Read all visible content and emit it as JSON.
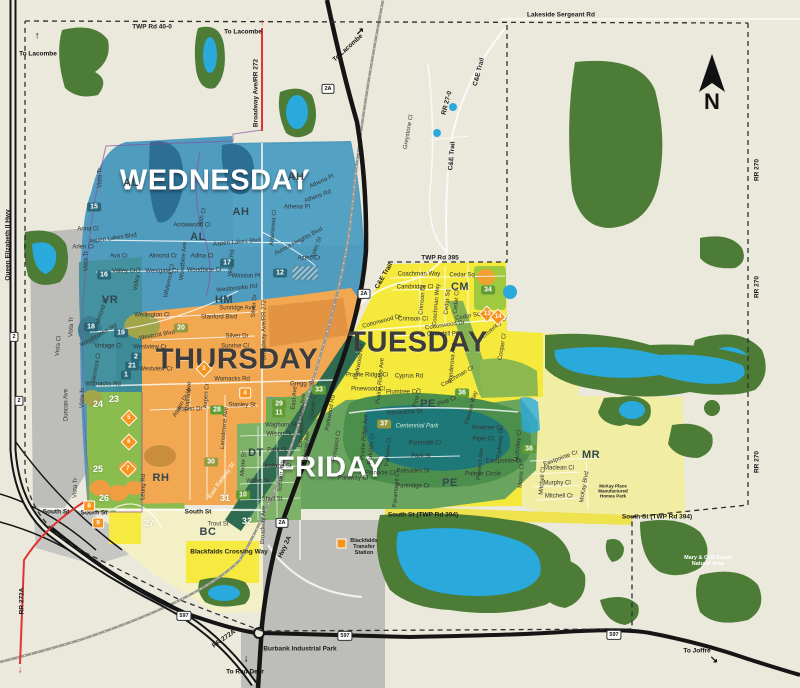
{
  "day_zones": [
    {
      "label": "WEDNESDAY",
      "color": "#4f9cbf"
    },
    {
      "label": "THURSDAY",
      "color": "#f2a850"
    },
    {
      "label": "TUESDAY",
      "color": "#f5e93b"
    },
    {
      "label": "FRIDAY",
      "color": "#6aa55f"
    }
  ],
  "north": {
    "label": "N"
  },
  "zone_letters": [
    {
      "t": "AH",
      "x": 296,
      "y": 177
    },
    {
      "t": "AH",
      "x": 241,
      "y": 212
    },
    {
      "t": "AL",
      "x": 131,
      "y": 183
    },
    {
      "t": "AL",
      "x": 198,
      "y": 237
    },
    {
      "t": "VR",
      "x": 110,
      "y": 300
    },
    {
      "t": "HM",
      "x": 224,
      "y": 300
    },
    {
      "t": "RH",
      "x": 161,
      "y": 478
    },
    {
      "t": "DT",
      "x": 256,
      "y": 453
    },
    {
      "t": "CM",
      "x": 460,
      "y": 287
    },
    {
      "t": "PE",
      "x": 428,
      "y": 404
    },
    {
      "t": "PE",
      "x": 450,
      "y": 483
    },
    {
      "t": "MR",
      "x": 591,
      "y": 455
    },
    {
      "t": "BC",
      "x": 208,
      "y": 532
    }
  ],
  "labels": [
    {
      "t": "TWP Rd 40-0",
      "x": 152,
      "y": 27,
      "k": "rd"
    },
    {
      "t": "Lakeside Sergeant Rd",
      "x": 561,
      "y": 15,
      "k": "rd"
    },
    {
      "t": "TWP Rd 395",
      "x": 440,
      "y": 258,
      "k": "rd"
    },
    {
      "t": "South St (TWP Rd 394)",
      "x": 423,
      "y": 515,
      "k": "rd"
    },
    {
      "t": "South St (TWP Rd 394)",
      "x": 657,
      "y": 517,
      "k": "rd"
    },
    {
      "t": "South St",
      "x": 56,
      "y": 512,
      "k": "rd"
    },
    {
      "t": "South St",
      "x": 94,
      "y": 513,
      "k": "rd"
    },
    {
      "t": "South St",
      "x": 198,
      "y": 512,
      "k": "rd"
    },
    {
      "t": "RR 270",
      "x": 757,
      "y": 170,
      "r": -90,
      "k": "rd"
    },
    {
      "t": "RR 270",
      "x": 757,
      "y": 287,
      "r": -90,
      "k": "rd"
    },
    {
      "t": "RR 270",
      "x": 757,
      "y": 462,
      "r": -90,
      "k": "rd"
    },
    {
      "t": "RR 27-0",
      "x": 447,
      "y": 103,
      "r": -75,
      "k": "rd"
    },
    {
      "t": "RR 272A",
      "x": 22,
      "y": 601,
      "r": -90,
      "k": "rd"
    },
    {
      "t": "RR 272A",
      "x": 224,
      "y": 639,
      "r": -35,
      "k": "rd"
    },
    {
      "t": "Broadway Ave/RR 272",
      "x": 256,
      "y": 93,
      "r": -90,
      "k": "rd"
    },
    {
      "t": "Queen Elizabeth II Hwy",
      "x": 8,
      "y": 245,
      "r": -90,
      "k": "rd"
    },
    {
      "t": "C&E Trail",
      "x": 479,
      "y": 72,
      "r": -75,
      "k": "rd"
    },
    {
      "t": "C&E Trail",
      "x": 452,
      "y": 156,
      "r": -85,
      "k": "rd"
    },
    {
      "t": "C&E Trail",
      "x": 384,
      "y": 276,
      "r": -60,
      "k": "rd"
    },
    {
      "t": "Hwy 2A",
      "x": 285,
      "y": 547,
      "r": -65,
      "k": "rd"
    },
    {
      "t": "Burbank Industrial Park",
      "x": 300,
      "y": 649,
      "k": "rd"
    },
    {
      "t": "Blackfalds Crossing Way",
      "x": 229,
      "y": 552,
      "k": "rd"
    },
    {
      "t": "To Lacombe",
      "x": 38,
      "y": 54,
      "k": "mk"
    },
    {
      "t": "To Lacombe",
      "x": 243,
      "y": 32,
      "k": "mk"
    },
    {
      "t": "To Lacombe",
      "x": 348,
      "y": 48,
      "r": -42,
      "k": "mk"
    },
    {
      "t": "To Red Deer",
      "x": 245,
      "y": 672,
      "k": "mk"
    },
    {
      "t": "To Joffre",
      "x": 697,
      "y": 651,
      "k": "mk"
    },
    {
      "t": "↑",
      "x": 37,
      "y": 36,
      "k": "ar"
    },
    {
      "t": "↓",
      "x": 246,
      "y": 659,
      "k": "ar"
    },
    {
      "t": "↘",
      "x": 714,
      "y": 660,
      "k": "ar"
    },
    {
      "t": "↗",
      "x": 360,
      "y": 32,
      "k": "ar"
    },
    {
      "t": "↑",
      "x": 262,
      "y": 23,
      "k": "arr"
    },
    {
      "t": "↓",
      "x": 20,
      "y": 670,
      "k": "arr"
    },
    {
      "t": "Blackfalds Transfer Station",
      "x": 364,
      "y": 547,
      "k": "poi",
      "w": 36
    },
    {
      "t": "Mary & Cliff Soper Natural Area",
      "x": 708,
      "y": 561,
      "k": "poiw",
      "w": 60
    },
    {
      "t": "Centennial Park",
      "x": 417,
      "y": 427,
      "k": "sp",
      "w": 46
    },
    {
      "t": "McKay Place Manufactured Homes Park",
      "x": 613,
      "y": 492,
      "k": "tiny",
      "w": 42
    },
    {
      "t": "Vista Tr",
      "x": 101,
      "y": 178,
      "r": -90
    },
    {
      "t": "Anna Cl",
      "x": 88,
      "y": 230
    },
    {
      "t": "Aspen Lakes Blvd",
      "x": 113,
      "y": 239,
      "r": -8
    },
    {
      "t": "Arlen Cl",
      "x": 83,
      "y": 248
    },
    {
      "t": "Ava Cr",
      "x": 119,
      "y": 257
    },
    {
      "t": "Vista Tr",
      "x": 87,
      "y": 261,
      "r": -90
    },
    {
      "t": "Almond Cr",
      "x": 163,
      "y": 257
    },
    {
      "t": "Adina Cl",
      "x": 202,
      "y": 257
    },
    {
      "t": "Valley Cr",
      "x": 124,
      "y": 272
    },
    {
      "t": "Westgate Cr",
      "x": 162,
      "y": 272
    },
    {
      "t": "Woodbine Cl",
      "x": 204,
      "y": 271
    },
    {
      "t": "Arrowwood Cl",
      "x": 192,
      "y": 226
    },
    {
      "t": "Ash Cl",
      "x": 203,
      "y": 217,
      "r": -75
    },
    {
      "t": "Aspen Lakes Blvd",
      "x": 237,
      "y": 243,
      "r": -5
    },
    {
      "t": "Athena Pl",
      "x": 322,
      "y": 182,
      "r": -25
    },
    {
      "t": "Athens Rd",
      "x": 318,
      "y": 197,
      "r": -20
    },
    {
      "t": "Athena Pl",
      "x": 297,
      "y": 208
    },
    {
      "t": "Alderwood Cl",
      "x": 274,
      "y": 228,
      "r": -85
    },
    {
      "t": "Aurora Heights Blvd",
      "x": 299,
      "y": 242,
      "r": -28
    },
    {
      "t": "Aztec St",
      "x": 317,
      "y": 248,
      "r": -70
    },
    {
      "t": "Aztec Cr",
      "x": 309,
      "y": 259
    },
    {
      "t": "Winston Pl",
      "x": 246,
      "y": 277
    },
    {
      "t": "Westbrooke Rd",
      "x": 237,
      "y": 289,
      "r": -6
    },
    {
      "t": "Willow Rd",
      "x": 232,
      "y": 263,
      "r": -85
    },
    {
      "t": "Valley Cl",
      "x": 138,
      "y": 279,
      "r": -80
    },
    {
      "t": "Whiterock Cl",
      "x": 170,
      "y": 281,
      "r": -78
    },
    {
      "t": "Woodbine Ave",
      "x": 184,
      "y": 261,
      "r": -85
    },
    {
      "t": "Vista Tr",
      "x": 72,
      "y": 327,
      "r": -88
    },
    {
      "t": "Valmond St",
      "x": 102,
      "y": 313,
      "r": -70
    },
    {
      "t": "Westbrooke Rd",
      "x": 99,
      "y": 336,
      "r": -30
    },
    {
      "t": "Vista Cl",
      "x": 59,
      "y": 346,
      "r": -85
    },
    {
      "t": "Vintage Cl",
      "x": 108,
      "y": 347
    },
    {
      "t": "Vermont Cl",
      "x": 97,
      "y": 368,
      "r": -80
    },
    {
      "t": "Womacks Rd",
      "x": 103,
      "y": 385
    },
    {
      "t": "Wellington Cl",
      "x": 152,
      "y": 316
    },
    {
      "t": "Westcott Blvd",
      "x": 157,
      "y": 336,
      "r": -10
    },
    {
      "t": "Westview Cr",
      "x": 150,
      "y": 348
    },
    {
      "t": "Westview Cr",
      "x": 156,
      "y": 370
    },
    {
      "t": "Sunridge Ave",
      "x": 237,
      "y": 309
    },
    {
      "t": "Stanford Blvd",
      "x": 219,
      "y": 318
    },
    {
      "t": "Silver Dr",
      "x": 237,
      "y": 337
    },
    {
      "t": "Sunrise Cl",
      "x": 235,
      "y": 347
    },
    {
      "t": "Silver Dr",
      "x": 255,
      "y": 306,
      "r": -85
    },
    {
      "t": "Broadway Ave/RR 272",
      "x": 265,
      "y": 330,
      "r": -90
    },
    {
      "t": "Womacks Rd",
      "x": 232,
      "y": 380
    },
    {
      "t": "Gregg St",
      "x": 302,
      "y": 385
    },
    {
      "t": "Stanley St",
      "x": 242,
      "y": 406
    },
    {
      "t": "Aspen Dr",
      "x": 190,
      "y": 410
    },
    {
      "t": "Poplar Ave",
      "x": 189,
      "y": 396,
      "r": -85
    },
    {
      "t": "Aspen Cr",
      "x": 207,
      "y": 396,
      "r": -85
    },
    {
      "t": "Aspen Dr W",
      "x": 183,
      "y": 403,
      "r": -60
    },
    {
      "t": "Leung Rd",
      "x": 144,
      "y": 487,
      "r": -88
    },
    {
      "t": "Lansdowne Ave",
      "x": 225,
      "y": 428,
      "r": -85
    },
    {
      "t": "Vista Tr",
      "x": 83,
      "y": 398,
      "r": -88
    },
    {
      "t": "Vista Tr",
      "x": 76,
      "y": 488,
      "r": -88
    },
    {
      "t": "Duncan Ave",
      "x": 67,
      "y": 405,
      "r": -90
    },
    {
      "t": "Trout St",
      "x": 218,
      "y": 525
    },
    {
      "t": "Waghorn St",
      "x": 281,
      "y": 426
    },
    {
      "t": "Wilson St",
      "x": 279,
      "y": 435
    },
    {
      "t": "East Ave",
      "x": 295,
      "y": 398,
      "r": -85
    },
    {
      "t": "Lawton Ave",
      "x": 303,
      "y": 409,
      "r": -85
    },
    {
      "t": "Queen Cl",
      "x": 314,
      "y": 406,
      "r": -85
    },
    {
      "t": "Park St",
      "x": 277,
      "y": 451
    },
    {
      "t": "East Ave",
      "x": 302,
      "y": 436,
      "r": -85
    },
    {
      "t": "Highway Ave",
      "x": 307,
      "y": 448,
      "r": -85
    },
    {
      "t": "Indiana St",
      "x": 278,
      "y": 467
    },
    {
      "t": "Winks St",
      "x": 258,
      "y": 482
    },
    {
      "t": "Schuler Ave",
      "x": 282,
      "y": 476,
      "r": -85
    },
    {
      "t": "Shull St",
      "x": 272,
      "y": 500
    },
    {
      "t": "Broadway Ave",
      "x": 264,
      "y": 525,
      "r": -88
    },
    {
      "t": "Moore St",
      "x": 244,
      "y": 464,
      "r": -85
    },
    {
      "t": "East Railway St",
      "x": 222,
      "y": 481,
      "r": -55,
      "k": "sw"
    },
    {
      "t": "Panorama Dr",
      "x": 405,
      "y": 413,
      "r": -4
    },
    {
      "t": "Pondside Cr",
      "x": 425,
      "y": 444
    },
    {
      "t": "Park St",
      "x": 421,
      "y": 457
    },
    {
      "t": "Palisades St",
      "x": 413,
      "y": 472
    },
    {
      "t": "Pinnacle Cl",
      "x": 380,
      "y": 474
    },
    {
      "t": "Parkway Cl",
      "x": 353,
      "y": 479
    },
    {
      "t": "Parkridge Cr",
      "x": 413,
      "y": 487
    },
    {
      "t": "Paramount Cr",
      "x": 397,
      "y": 489,
      "r": -85
    },
    {
      "t": "Parkwood Rd",
      "x": 331,
      "y": 413,
      "r": -80
    },
    {
      "t": "Parkwood Rd",
      "x": 360,
      "y": 362,
      "r": -80
    },
    {
      "t": "Prospect Cl",
      "x": 337,
      "y": 446,
      "r": -80
    },
    {
      "t": "Prairie Ridge Ave",
      "x": 365,
      "y": 437,
      "r": -85
    },
    {
      "t": "Parkside Cr",
      "x": 372,
      "y": 449,
      "r": -85
    },
    {
      "t": "Parview Cl",
      "x": 389,
      "y": 452,
      "r": -85
    },
    {
      "t": "Coachman Way",
      "x": 419,
      "y": 275
    },
    {
      "t": "Cedar Sq",
      "x": 462,
      "y": 276
    },
    {
      "t": "Cambridge Cl",
      "x": 415,
      "y": 288
    },
    {
      "t": "Crimson Cl",
      "x": 423,
      "y": 300,
      "r": -85
    },
    {
      "t": "Coachman Way",
      "x": 437,
      "y": 305,
      "r": -85
    },
    {
      "t": "Cedar Sq",
      "x": 448,
      "y": 302,
      "r": -85
    },
    {
      "t": "Cedar Cl",
      "x": 457,
      "y": 302,
      "r": -85
    },
    {
      "t": "Crimson Cl",
      "x": 413,
      "y": 320
    },
    {
      "t": "Cedar Sq",
      "x": 468,
      "y": 317,
      "r": -10
    },
    {
      "t": "Cottonwood Dr",
      "x": 445,
      "y": 326,
      "r": -8
    },
    {
      "t": "Cottonwood Dr",
      "x": 382,
      "y": 322,
      "r": -15
    },
    {
      "t": "Coventry Cl",
      "x": 495,
      "y": 328,
      "r": -40
    },
    {
      "t": "Churchill Pl",
      "x": 442,
      "y": 335
    },
    {
      "t": "Ponderosa Ave",
      "x": 453,
      "y": 363,
      "r": -85
    },
    {
      "t": "Cyprus Rd",
      "x": 409,
      "y": 377
    },
    {
      "t": "Coachman Cr",
      "x": 458,
      "y": 377,
      "r": -30
    },
    {
      "t": "Cooper Cl",
      "x": 503,
      "y": 347,
      "r": -80
    },
    {
      "t": "Plumtree Cr",
      "x": 402,
      "y": 393
    },
    {
      "t": "Pine Cl",
      "x": 418,
      "y": 398,
      "r": -75
    },
    {
      "t": "Pine Cl",
      "x": 447,
      "y": 402,
      "r": -20
    },
    {
      "t": "Prairie Ridge Cl",
      "x": 367,
      "y": 376
    },
    {
      "t": "Pinewood Cl",
      "x": 368,
      "y": 390
    },
    {
      "t": "Prairie Ridge Ave",
      "x": 381,
      "y": 381,
      "r": -85
    },
    {
      "t": "Pioneer Way",
      "x": 472,
      "y": 408,
      "r": -75
    },
    {
      "t": "Piper Cl",
      "x": 483,
      "y": 440
    },
    {
      "t": "Pinetree Cl",
      "x": 487,
      "y": 429
    },
    {
      "t": "Parkway Dr",
      "x": 501,
      "y": 443,
      "r": -85
    },
    {
      "t": "McKinley Cl",
      "x": 519,
      "y": 446,
      "r": -85
    },
    {
      "t": "Eastpointe Dr",
      "x": 504,
      "y": 462
    },
    {
      "t": "Palmer Circle",
      "x": 483,
      "y": 475
    },
    {
      "t": "Pioneer Ave",
      "x": 481,
      "y": 464,
      "r": -85
    },
    {
      "t": "Morris Cl",
      "x": 522,
      "y": 476,
      "r": -85
    },
    {
      "t": "Eastpointe Cr",
      "x": 561,
      "y": 459,
      "r": -20
    },
    {
      "t": "Maclean Cl",
      "x": 559,
      "y": 469
    },
    {
      "t": "Murphy Cl",
      "x": 557,
      "y": 484
    },
    {
      "t": "Mitchell Cr",
      "x": 559,
      "y": 497
    },
    {
      "t": "Mitchell Cl",
      "x": 543,
      "y": 481,
      "r": -85
    },
    {
      "t": "McKay Blvd",
      "x": 585,
      "y": 487,
      "r": -80
    },
    {
      "t": "Greystone Cl",
      "x": 409,
      "y": 132,
      "r": -80
    }
  ],
  "badges": [
    {
      "n": "15",
      "x": 94,
      "y": 207,
      "k": "teal"
    },
    {
      "n": "16",
      "x": 104,
      "y": 275,
      "k": "teal"
    },
    {
      "n": "17",
      "x": 227,
      "y": 263,
      "k": "teal"
    },
    {
      "n": "12",
      "x": 280,
      "y": 273,
      "k": "teal"
    },
    {
      "n": "18",
      "x": 91,
      "y": 327,
      "k": "teal"
    },
    {
      "n": "19",
      "x": 121,
      "y": 333,
      "k": "teal"
    },
    {
      "n": "2",
      "x": 136,
      "y": 357,
      "k": "teal"
    },
    {
      "n": "21",
      "x": 132,
      "y": 366,
      "k": "teal"
    },
    {
      "n": "1",
      "x": 126,
      "y": 375,
      "k": "teal"
    },
    {
      "n": "20",
      "x": 181,
      "y": 328,
      "k": "olive"
    },
    {
      "n": "30",
      "x": 211,
      "y": 462,
      "k": "olive"
    },
    {
      "n": "37",
      "x": 384,
      "y": 424,
      "k": "olive"
    },
    {
      "n": "28",
      "x": 217,
      "y": 410,
      "k": "green"
    },
    {
      "n": "29",
      "x": 279,
      "y": 404,
      "k": "green"
    },
    {
      "n": "11",
      "x": 279,
      "y": 413,
      "k": "green"
    },
    {
      "n": "33",
      "x": 319,
      "y": 390,
      "k": "green"
    },
    {
      "n": "34",
      "x": 488,
      "y": 290,
      "k": "green"
    },
    {
      "n": "36",
      "x": 462,
      "y": 393,
      "k": "green"
    },
    {
      "n": "38",
      "x": 529,
      "y": 449,
      "k": "green"
    },
    {
      "n": "10",
      "x": 243,
      "y": 495,
      "k": "green"
    },
    {
      "n": "23",
      "x": 114,
      "y": 399,
      "k": "white"
    },
    {
      "n": "24",
      "x": 98,
      "y": 404,
      "k": "white"
    },
    {
      "n": "25",
      "x": 98,
      "y": 469,
      "k": "white"
    },
    {
      "n": "26",
      "x": 104,
      "y": 498,
      "k": "white"
    },
    {
      "n": "27",
      "x": 149,
      "y": 523,
      "k": "white"
    },
    {
      "n": "31",
      "x": 225,
      "y": 498,
      "k": "white"
    },
    {
      "n": "32",
      "x": 247,
      "y": 521,
      "k": "white"
    },
    {
      "n": "4",
      "x": 245,
      "y": 393,
      "k": "orange"
    },
    {
      "n": "8",
      "x": 89,
      "y": 506,
      "k": "orange"
    },
    {
      "n": "9",
      "x": 98,
      "y": 523,
      "k": "orange"
    },
    {
      "n": "3",
      "x": 204,
      "y": 369,
      "k": "od"
    },
    {
      "n": "5",
      "x": 129,
      "y": 418,
      "k": "od"
    },
    {
      "n": "6",
      "x": 129,
      "y": 442,
      "k": "od"
    },
    {
      "n": "7",
      "x": 128,
      "y": 469,
      "k": "od"
    },
    {
      "n": "13",
      "x": 487,
      "y": 314,
      "k": "od"
    },
    {
      "n": "14",
      "x": 498,
      "y": 317,
      "k": "od"
    }
  ],
  "shields": [
    {
      "t": "2A",
      "x": 328,
      "y": 89
    },
    {
      "t": "2A",
      "x": 364,
      "y": 294
    },
    {
      "t": "2A",
      "x": 282,
      "y": 523
    },
    {
      "t": "597",
      "x": 184,
      "y": 616
    },
    {
      "t": "597",
      "x": 345,
      "y": 636
    },
    {
      "t": "597",
      "x": 614,
      "y": 635
    },
    {
      "t": "2",
      "x": 14,
      "y": 337
    },
    {
      "t": "2",
      "x": 19,
      "y": 401
    }
  ],
  "colors": {
    "background": "#ebe8dc",
    "wednesday": "#4f9cbf",
    "thursday": "#f2a850",
    "tuesday": "#f5e93b",
    "friday": "#6aa55f",
    "forest": "#4c7c36",
    "water": "#2aa9dc",
    "industrial": "#bdbdb9",
    "badge_orange": "#f7941d",
    "boundary_red": "#e23333"
  }
}
